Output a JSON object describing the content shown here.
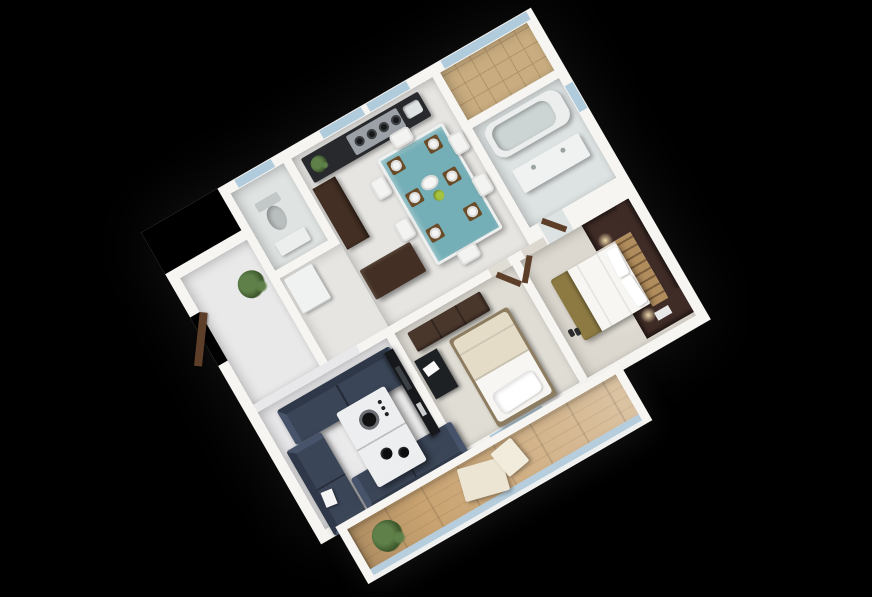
{
  "scene": {
    "type": "3d-floor-plan-render",
    "rotation_deg": -30,
    "visible_text": ""
  },
  "colors": {
    "background": "#000000",
    "wall": "#f6f5f2",
    "floor_hall": "#e9e9ea",
    "floor_wc": "#dfe3e2",
    "floor_kitchen": "#e6e5e2",
    "floor_living": "#e8e8ea",
    "floor_bed2": "#e0ddd5",
    "floor_master": "#dcd8cf",
    "floor_bath": "#dde2e2",
    "tile_tan": "#c9ad80",
    "tile_line": "#b19368",
    "wood_deck": "#c9a371",
    "glass": "#a9c6d8",
    "sofa": "#3a4557",
    "sofa_dark": "#2e3848",
    "sofa_light": "#46536b",
    "table_white": "#edeef0",
    "teal": "#74aeb6",
    "placemat": "#6b4c29",
    "plate": "#f4f4f4",
    "counter": "#27292d",
    "steel": "#9ba1a7",
    "wood_dark": "#432f23",
    "wood_door": "#5d3e28",
    "wardrobe": "#402c27",
    "headboard": "#b18c5c",
    "olive": "#8c7a42",
    "bedding": "#f7f6f3",
    "cream": "#e5dcc8",
    "black_unit": "#16181b",
    "fixture": "#eceeee",
    "fixture_gray": "#c2c8c8",
    "plant": "#5f8049",
    "plant_dark": "#3a5429",
    "glow_warm": "rgba(255,233,184,0.9)"
  },
  "rooms": [
    {
      "name": "entrance-hall",
      "furniture": [
        "entry-door",
        "potted-plant"
      ]
    },
    {
      "name": "wc",
      "furniture": [
        "toilet",
        "small-vanity",
        "window"
      ]
    },
    {
      "name": "kitchen-dining",
      "furniture": [
        "counter-with-stove",
        "sink",
        "counter-plant",
        "tall-cabinet",
        "fridge",
        "island",
        "dining-table"
      ],
      "burners": 4,
      "place_settings": 6,
      "chairs": 6,
      "windows": 2
    },
    {
      "name": "utility-balcony",
      "furniture": [
        "tiled-floor",
        "glass-edge"
      ]
    },
    {
      "name": "bathroom",
      "furniture": [
        "bathtub",
        "vanity-unit",
        "door",
        "window"
      ]
    },
    {
      "name": "living-room",
      "furniture": [
        "sofa-top",
        "sofa-left",
        "sofa-bottom",
        "coffee-table",
        "speaker-decor",
        "bowls",
        "tv-unit",
        "magazine"
      ],
      "sofas": 3
    },
    {
      "name": "bedroom-small",
      "furniture": [
        "single-bed",
        "pillow",
        "blanket",
        "dresser",
        "desk-unit",
        "door"
      ]
    },
    {
      "name": "bedroom-master",
      "furniture": [
        "double-bed",
        "slat-headboard",
        "wardrobe-wall-unit",
        "niche-lamp-top",
        "niche-lamp-bottom",
        "olive-runner",
        "pillows",
        "slippers",
        "door"
      ],
      "pillows": 2
    },
    {
      "name": "balcony",
      "furniture": [
        "wood-deck",
        "lounge-chair",
        "potted-plant",
        "glass-railing"
      ]
    }
  ]
}
